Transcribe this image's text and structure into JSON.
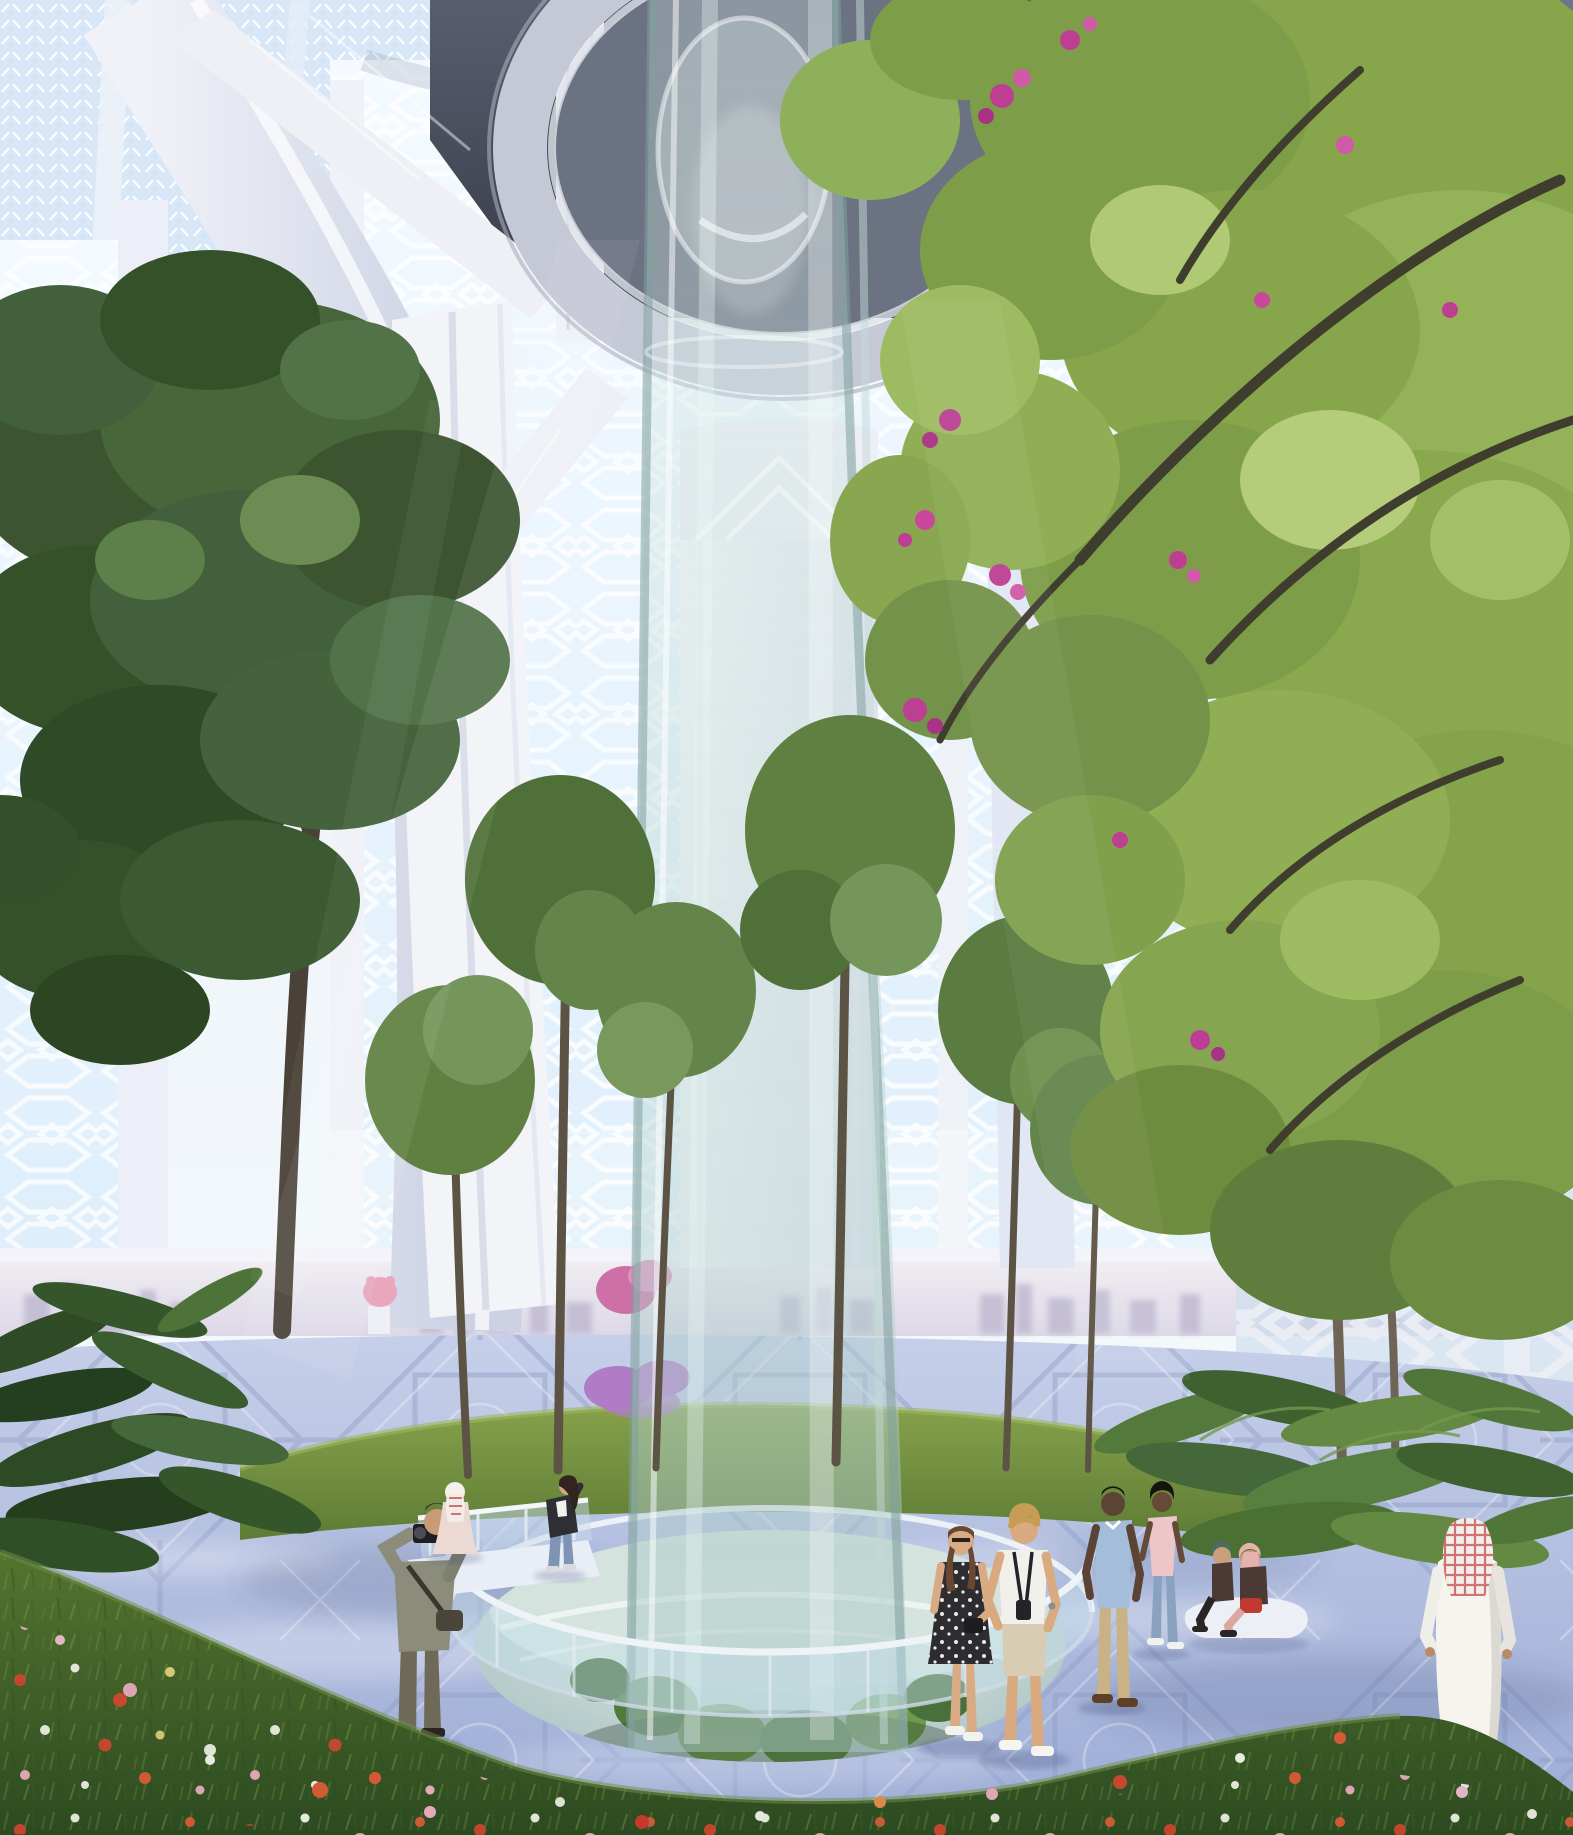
{
  "meta": {
    "title": "Futuristic biophilic skyscraper atrium rendering",
    "description": "Architectural rendering of a vast atrium garden inside a tower: a glass elevator/waterfall tube descends from a domed oculus to a sunken circular pool, surrounded by trees, ferns, a wildflower meadow, patterned pavement, mashrabiya lattice window walls with a hazy city skyline, and visitors strolling."
  },
  "scene": {
    "architecture": {
      "style": "parametric Arabic / biophilic atrium",
      "features": [
        "coffered vault with circular oculus",
        "white structural ribs and sweeping arches",
        "perforated mashrabiya lattice curtain walls",
        "central glass cylinder",
        "sunken pool with glass balustrade",
        "geometric patterned plaza pavement"
      ]
    },
    "palette": {
      "skyTop": "#e9f1f9",
      "skyBottom": "#f7fafc",
      "windowGlowTop": "#f4faff",
      "windowGlowBottom": "#ddeefb",
      "vaultLight": "#585e6f",
      "vaultDark": "#363a46",
      "ringGrey": "#c5c9d6",
      "ribWhite": "#eef0f6",
      "archLit": "#f1f2f8",
      "archShadow": "#ccd2e4",
      "coreLit": "#f6f7fa",
      "coreShade": "#dfe3ee",
      "glassTop": "rgba(216,233,230,0.30)",
      "glassMid": "rgba(196,220,216,0.44)",
      "glassBottom": "rgba(168,199,199,0.52)",
      "glassEdge": "rgba(128,158,156,0.55)",
      "glassRail": "rgba(198,223,234,0.45)",
      "pavementLight": "#c6cfe9",
      "pavementDark": "#9cacd5",
      "pavementLine": "rgba(255,255,255,0.30)",
      "hazeTop": "#f2eef3",
      "hazeBottom": "#dcd8e7",
      "skylineSilhouette": "#c0bad1",
      "islandLight": "#87a14b",
      "islandDark": "#5d7c35",
      "meadowLight": "#547430",
      "meadowDark": "#2c4a20",
      "pitCenter": "#e2eae4",
      "pitEdge": "#a6c1c1",
      "leftCanopyMid": "#43603316",
      "leftCanopy": "#43603a",
      "rightCanopyMid": "#8aa94e",
      "midTreeGreen": "#63854a",
      "fernDark": "#2e4b26",
      "fernMid": "#53793b",
      "trunk": "#4a4138",
      "branch": "#3f3d2e",
      "blossomMagenta": "#bd3f93",
      "lilac": "#b07cc6",
      "pinkShrub": "#e8a7bd",
      "flowerRed": "#c8472f",
      "flowerOrange": "#d45a36",
      "flowerPink": "#e5a9ba",
      "flowerWhite": "#e9ebdf",
      "flowerYellow": "#d9c873",
      "benchWhite": "#edeff6",
      "shadowBlue": "#3d4a78"
    },
    "people": [
      {
        "id": "photographer",
        "pose": "standing, taking a photo",
        "colors": {
          "jacket": "#8b8d7a",
          "pants": "#6f6a58",
          "bag": "#49453b",
          "hair": "#3a2e24",
          "skin": "#c89a76",
          "camera": "#1f1f22"
        }
      },
      {
        "id": "woman-light-robe",
        "pose": "walking away in pale robe with red-checked scarf",
        "colors": {
          "robe": "#ecd9d4",
          "scarf": "#f4f0ea",
          "check": "#c24a44"
        }
      },
      {
        "id": "woman-at-railing",
        "pose": "leaning on glass railing",
        "colors": {
          "jacket": "#2e2e34",
          "shirt": "#f1f1ee",
          "jeans": "#7f94b5",
          "hair": "#32251d",
          "skin": "#d5a886"
        }
      },
      {
        "id": "woman-floral-dress",
        "pose": "strolling, smiling",
        "colors": {
          "dress": "#2c2c31",
          "pattern": "#ece9e2",
          "hair": "#6a4730",
          "skin": "#d8ab85",
          "shoes": "#f2f2ee",
          "bag": "#1d1d20"
        }
      },
      {
        "id": "man-white-tshirt",
        "pose": "strolling with camera strap",
        "colors": {
          "shirt": "#f2f0ea",
          "shorts": "#d8cdb2",
          "hair": "#c79c55",
          "skin": "#d9a97f",
          "shoes": "#f4f4f0",
          "strap": "#23232a"
        }
      },
      {
        "id": "man-blue-shirt",
        "pose": "walking toward viewer",
        "colors": {
          "shirt": "#a3bddb",
          "trousers": "#c9b286",
          "skin": "#5b4434",
          "hair": "#17130f",
          "shoes": "#5e3f28"
        }
      },
      {
        "id": "woman-pink-top",
        "pose": "walking beside man in blue shirt",
        "colors": {
          "top": "#ecc6c9",
          "jeans": "#8aa2c0",
          "skin": "#654a38",
          "hair": "#17130f",
          "shoes": "#f1f1ee"
        }
      },
      {
        "id": "seated-women-on-bench",
        "pose": "two women seated on white organic bench",
        "colors": {
          "bench": "#edeff6",
          "hijabPink": "#e5b1ac",
          "scarfTeal": "#4e6b66",
          "cardigan": "#4b3a33",
          "skirt": "#bf3a31",
          "pants": "#d8a7a0",
          "dark": "#2a2626"
        }
      },
      {
        "id": "man-white-thobe",
        "pose": "walking away in white thobe and red-white keffiyeh",
        "colors": {
          "thobe": "#f6f4ef",
          "shade": "#dcd8d2",
          "keffiyeh": "#f2eeea",
          "check": "#c34343",
          "shoes": "#2e2520"
        }
      }
    ],
    "flora": {
      "left_trees": "tall dark-green broadleaf trees",
      "right_canopy": "large bauhinia-like tree, light green round leaves with magenta blossoms",
      "midground_trees": 6,
      "ferns": "fern beds left and right",
      "shrubs": [
        "lilac shrub near pool",
        "pink shrub near photographer"
      ],
      "wildflowers": [
        "red",
        "orange-red",
        "pink",
        "white",
        "pale-yellow"
      ]
    },
    "lighting": "soft daylight filtering through perforated screens, dappled light on pavement"
  }
}
